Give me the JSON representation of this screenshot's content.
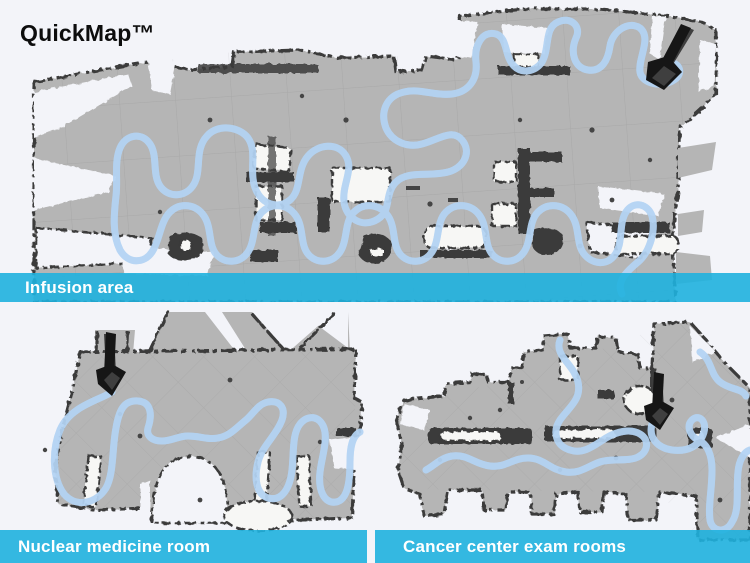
{
  "title": "QuickMap™",
  "colors": {
    "background": "#f3f4f9",
    "banner": "#1fb1de",
    "banner_text": "#ffffff",
    "floor": "#b5b5b5",
    "wall": "#3a3a3a",
    "path_core": "#5b9fe6",
    "path_halo": "#b3d3f3",
    "arrow": "#161616",
    "title_color": "#0d0d0d"
  },
  "panels": [
    {
      "id": "infusion",
      "label": "Infusion area"
    },
    {
      "id": "nuclear-medicine",
      "label": "Nuclear medicine room"
    },
    {
      "id": "cancer-center",
      "label": "Cancer center exam rooms"
    }
  ]
}
